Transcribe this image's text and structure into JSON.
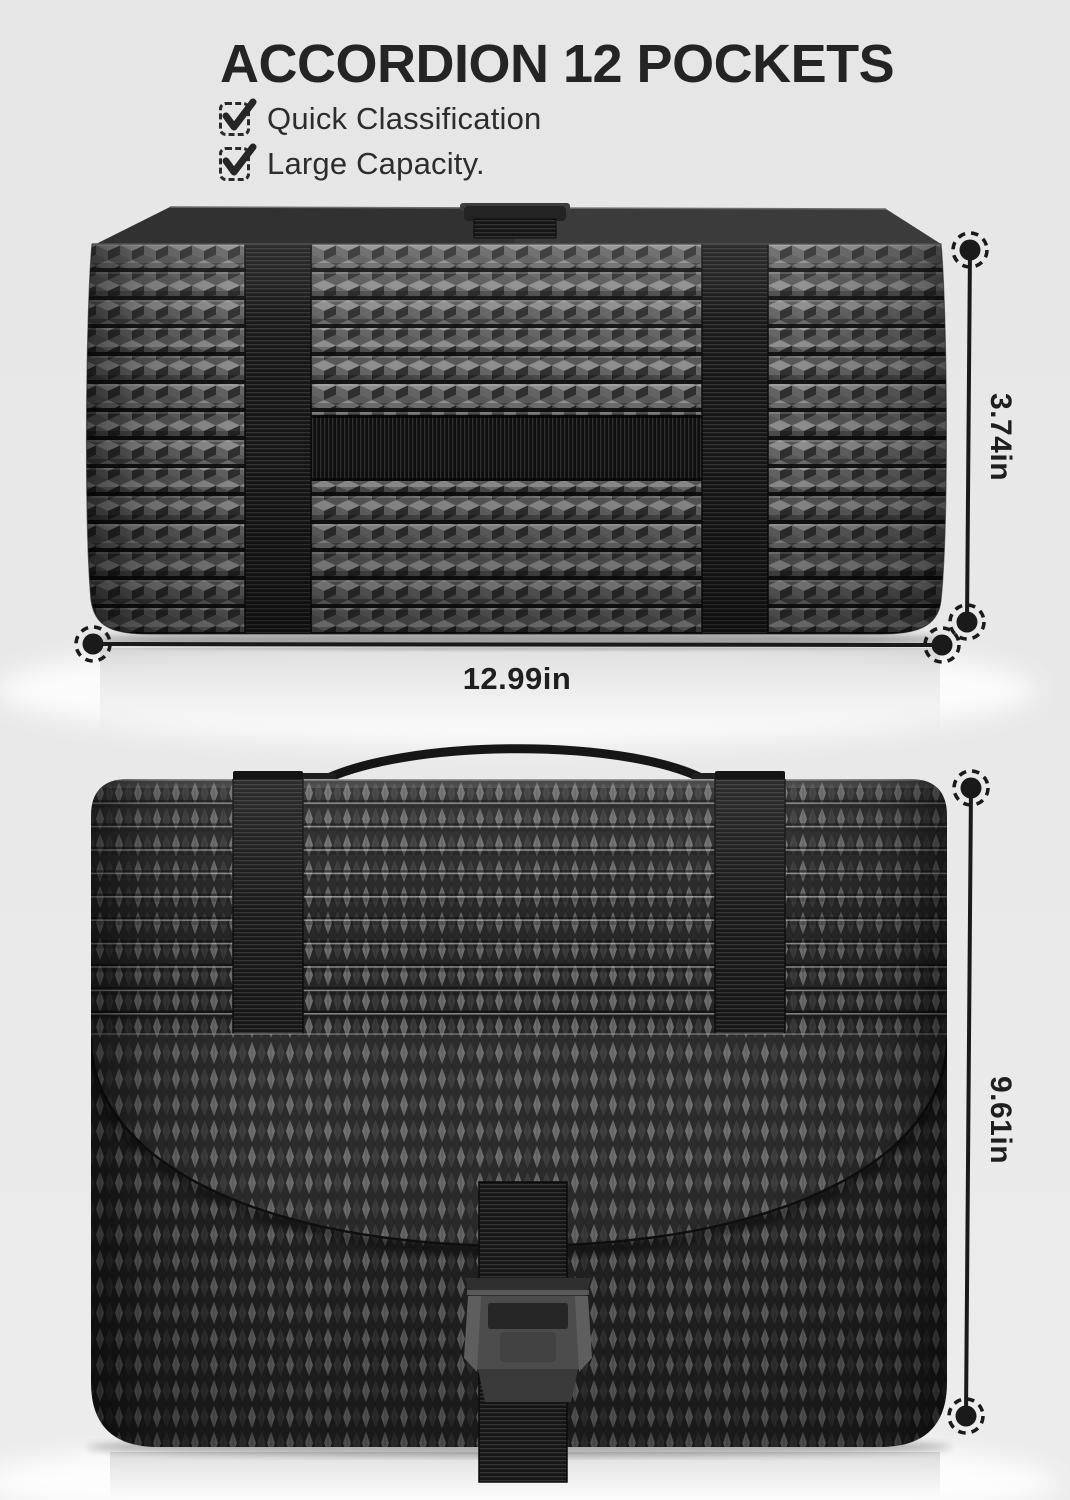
{
  "header": {
    "title": "ACCORDION 12 POCKETS",
    "features": [
      {
        "label": "Quick Classification"
      },
      {
        "label": "Large Capacity."
      }
    ]
  },
  "dimensions": {
    "side_height_label": "3.74in",
    "width_label": "12.99in",
    "front_height_label": "9.61in"
  },
  "product": {
    "top_view_name": "accordion-file-organizer-closed-top-view",
    "front_view_name": "accordion-file-organizer-front-view-with-flap-and-buckle"
  },
  "colors": {
    "background": "#e7e7e7",
    "ink": "#242424",
    "annotation_line": "#1a1a1a",
    "product_dark": "#1c1c1c",
    "product_mid": "#555555",
    "product_light": "#8f8f8f"
  }
}
